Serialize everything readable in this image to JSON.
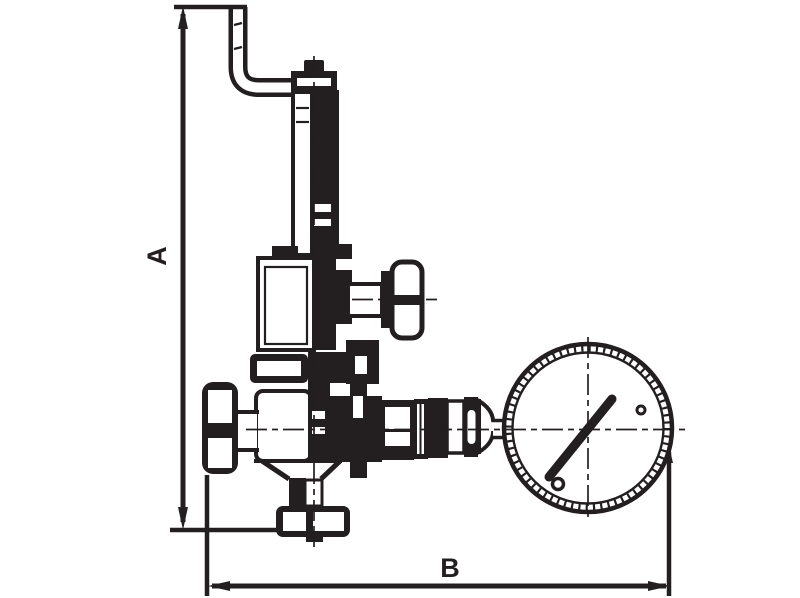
{
  "diagram": {
    "type": "technical-drawing",
    "subject": "Dimensioned outline drawing of a safety relief valve assembly with discharge pipe, test handle, shut-off handwheel and pressure gauge",
    "ink_color": "#231f20",
    "background_color": "#ffffff",
    "dimensions": {
      "a": {
        "label": "A",
        "axis": "vertical"
      },
      "b": {
        "label": "B",
        "axis": "horizontal"
      }
    },
    "parts": [
      "discharge-pipe-elbow",
      "adjusting-cap",
      "spring-bonnet-column",
      "spring-housing",
      "test-handle",
      "shutoff-handwheel",
      "valve-body",
      "inlet-hex-union",
      "gauge-union-fittings",
      "pressure-gauge",
      "gauge-needle"
    ]
  }
}
